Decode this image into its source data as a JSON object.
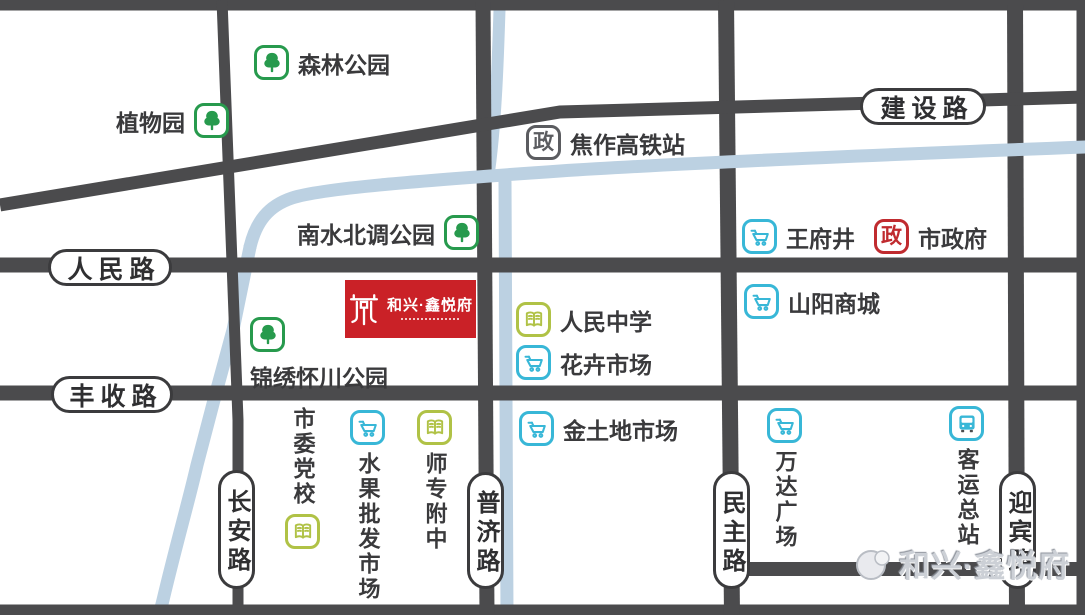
{
  "colors": {
    "road": "#4b4b4d",
    "river": "#bcd1e2",
    "park_green": "#279a4d",
    "market_cyan": "#38b7d7",
    "school_lime": "#b0c246",
    "gov_gray": "#5b5c60",
    "gov_red": "#c02b2f",
    "logo_red": "#ca2127"
  },
  "roads": {
    "jianshe": "建设路",
    "renmin": "人民路",
    "fengshou": "丰收路",
    "changan": "长安路",
    "puji": "普济路",
    "minzhu": "民主路",
    "yingbin": "迎宾路"
  },
  "pois": {
    "senlin": {
      "label": "森林公园",
      "icon": "tree-icon"
    },
    "zhiwu": {
      "label": "植物园",
      "icon": "tree-icon"
    },
    "gaotie": {
      "label": "焦作高铁站",
      "icon": "gov-icon-gray"
    },
    "nanshui": {
      "label": "南水北调公园",
      "icon": "tree-icon"
    },
    "wangfujing": {
      "label": "王府井",
      "icon": "cart-icon"
    },
    "shizhengfu": {
      "label": "市政府",
      "icon": "gov-icon-red"
    },
    "renmin_school": {
      "label": "人民中学",
      "icon": "book-icon"
    },
    "huahui": {
      "label": "花卉市场",
      "icon": "cart-icon"
    },
    "shanyang": {
      "label": "山阳商城",
      "icon": "cart-icon"
    },
    "jinxiu": {
      "label": "锦绣怀川公园",
      "icon": "tree-icon"
    },
    "shiwei": {
      "label": "市委党校",
      "icon": "book-icon"
    },
    "shuiguo": {
      "label": "水果批发市场",
      "icon": "cart-icon"
    },
    "shizhuan": {
      "label": "师专附中",
      "icon": "book-icon"
    },
    "jintudi": {
      "label": "金土地市场",
      "icon": "cart-icon"
    },
    "wanda": {
      "label": "万达广场",
      "icon": "cart-icon"
    },
    "keyun": {
      "label": "客运总站",
      "icon": "bus-icon"
    }
  },
  "gov_char": "政",
  "logo": {
    "name": "和兴·鑫悦府"
  },
  "watermark": {
    "name": "和兴·鑫悦府"
  }
}
